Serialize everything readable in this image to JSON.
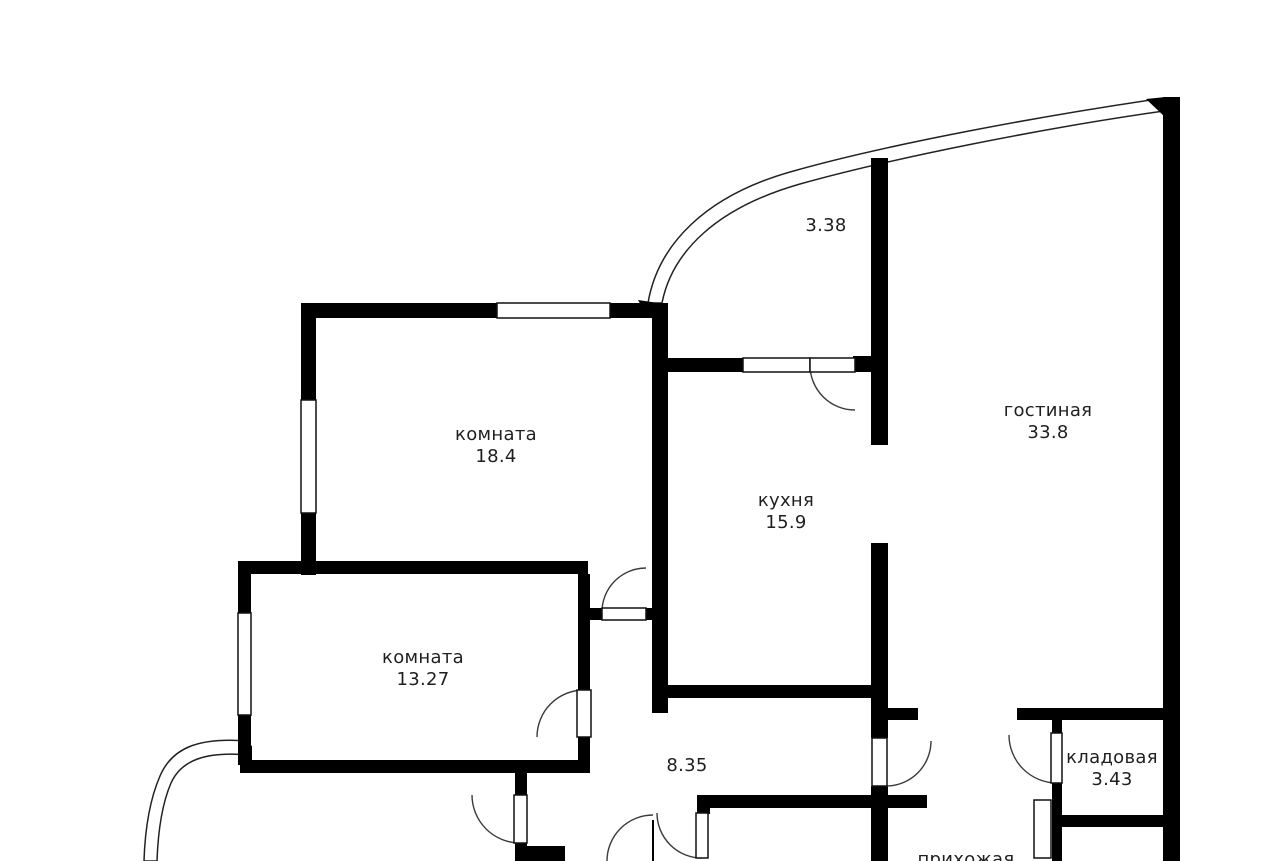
{
  "plan": {
    "type": "apartment-floor-plan",
    "wall_color": "#000000",
    "background_color": "#ffffff",
    "rooms": [
      {
        "id": "room-18-4",
        "name": "комната",
        "area": "18.4"
      },
      {
        "id": "kitchen",
        "name": "кухня",
        "area": "15.9"
      },
      {
        "id": "living-room",
        "name": "гостиная",
        "area": "33.8"
      },
      {
        "id": "balcony-top",
        "name": "",
        "area": "3.38"
      },
      {
        "id": "room-13-27",
        "name": "комната",
        "area": "13.27"
      },
      {
        "id": "hallway",
        "name": "",
        "area": "8.35"
      },
      {
        "id": "storage",
        "name": "кладовая",
        "area": "3.43"
      },
      {
        "id": "entry-hall",
        "name": "прихожая",
        "area": ""
      }
    ]
  }
}
